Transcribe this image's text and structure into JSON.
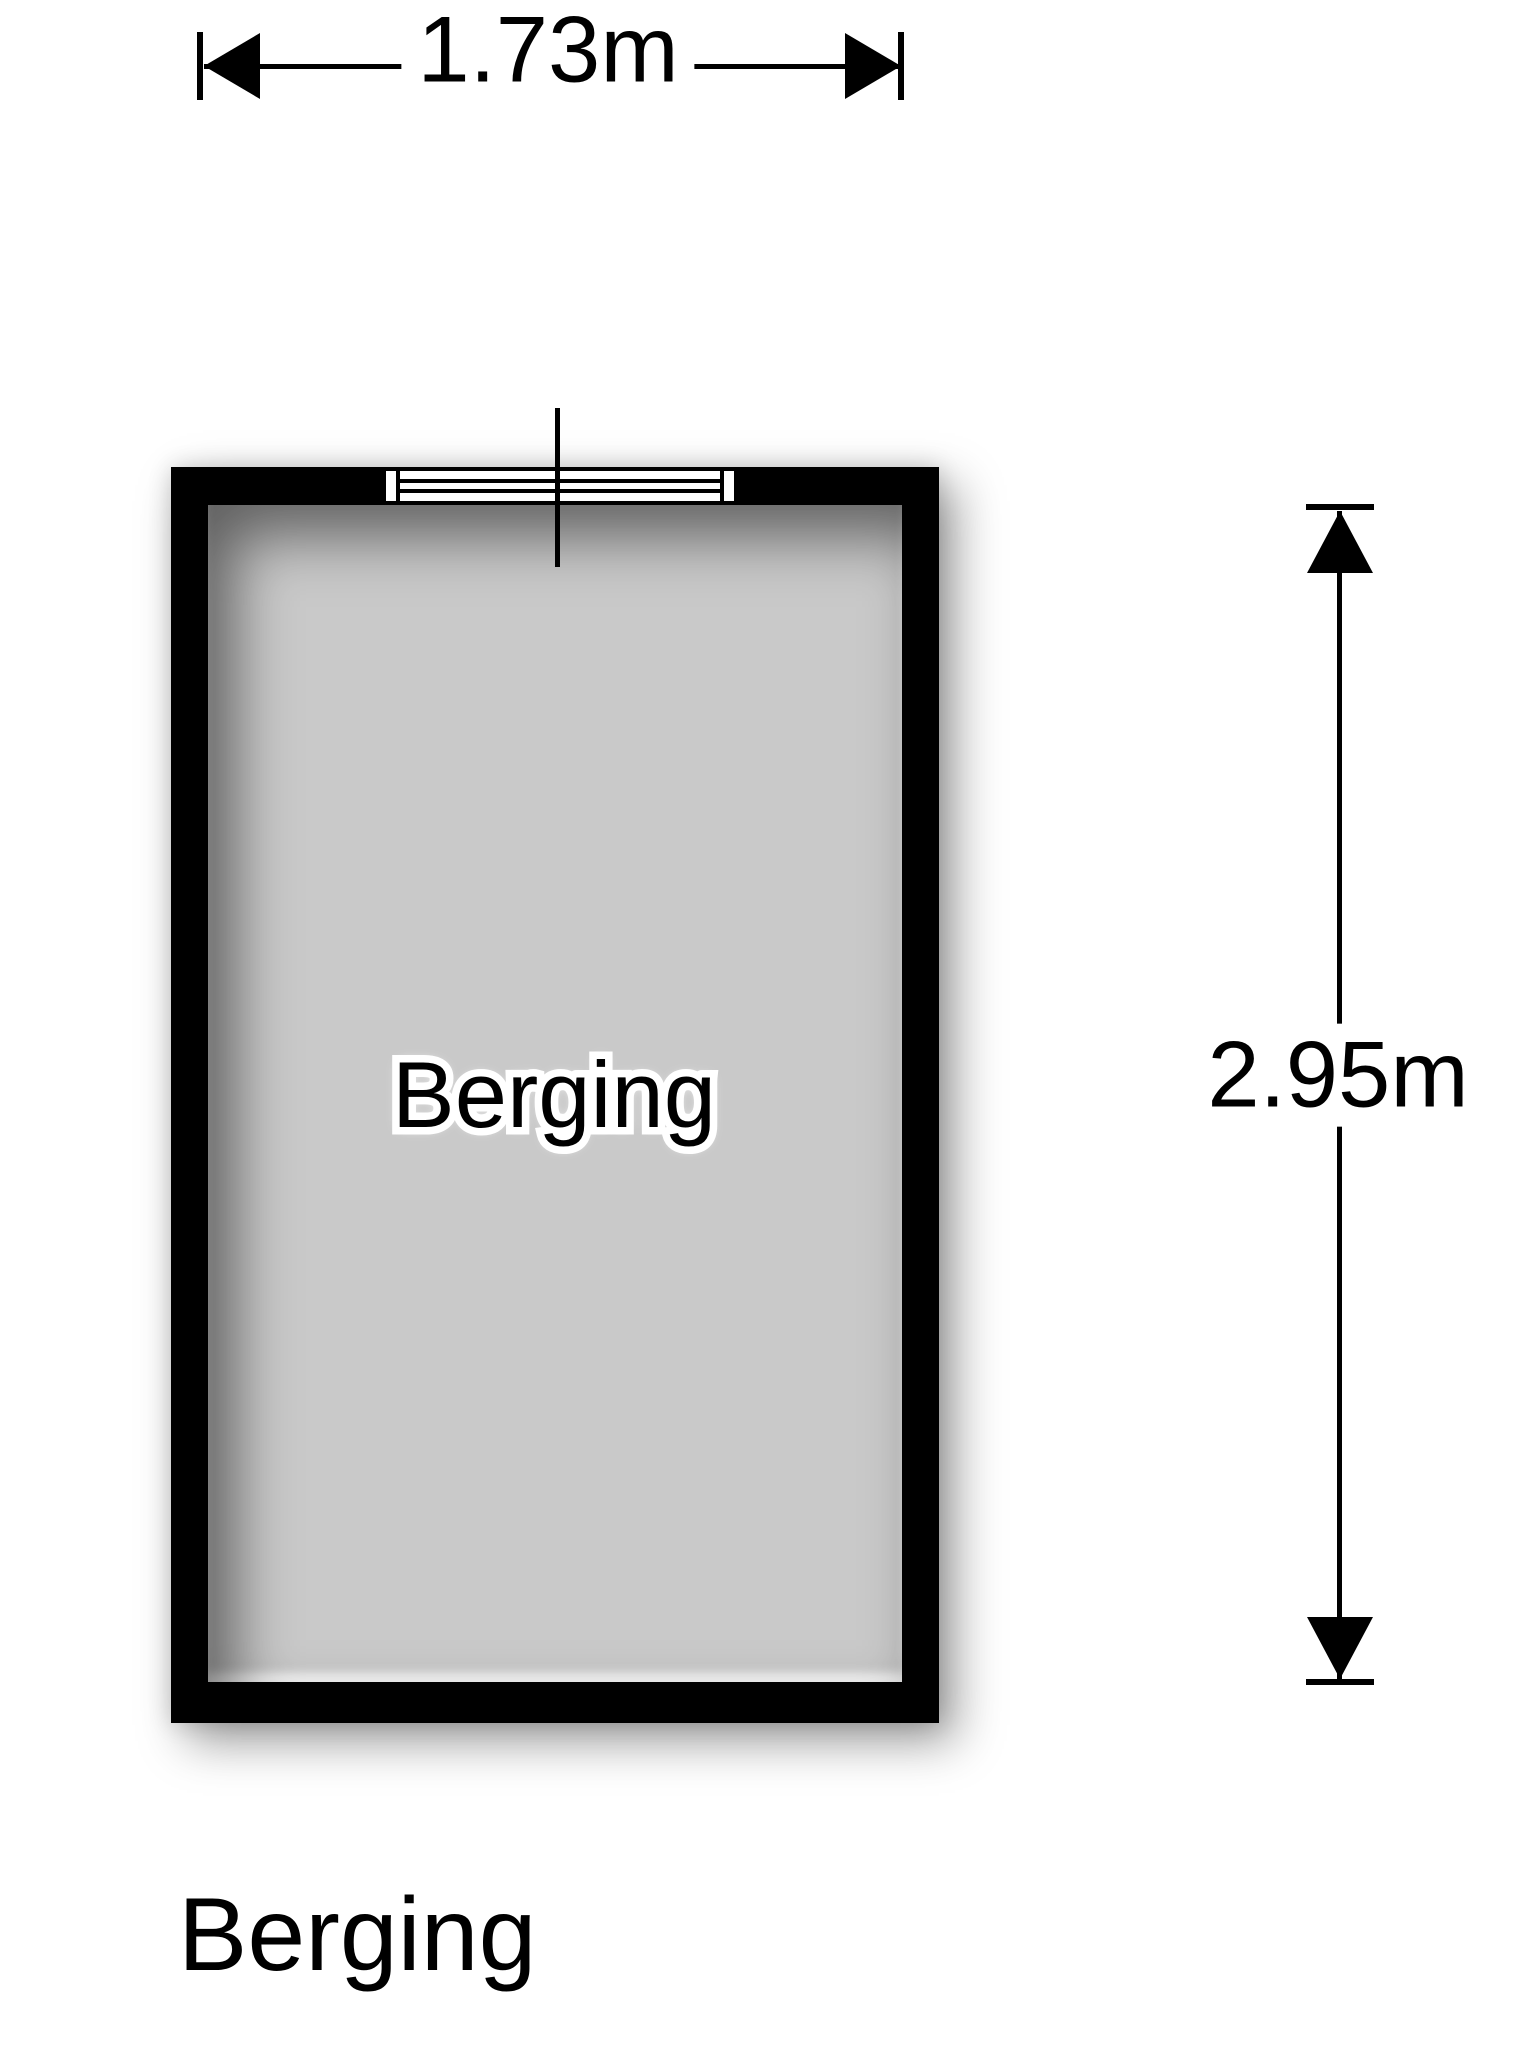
{
  "plan": {
    "title": "Berging",
    "room": {
      "label": "Berging",
      "width_label": "1.73m",
      "height_label": "2.95m"
    },
    "features": [
      "window-top-wall"
    ],
    "colors": {
      "wall": "#000000",
      "floor": "#c9c9c9",
      "background": "#ffffff",
      "text": "#000000"
    }
  }
}
